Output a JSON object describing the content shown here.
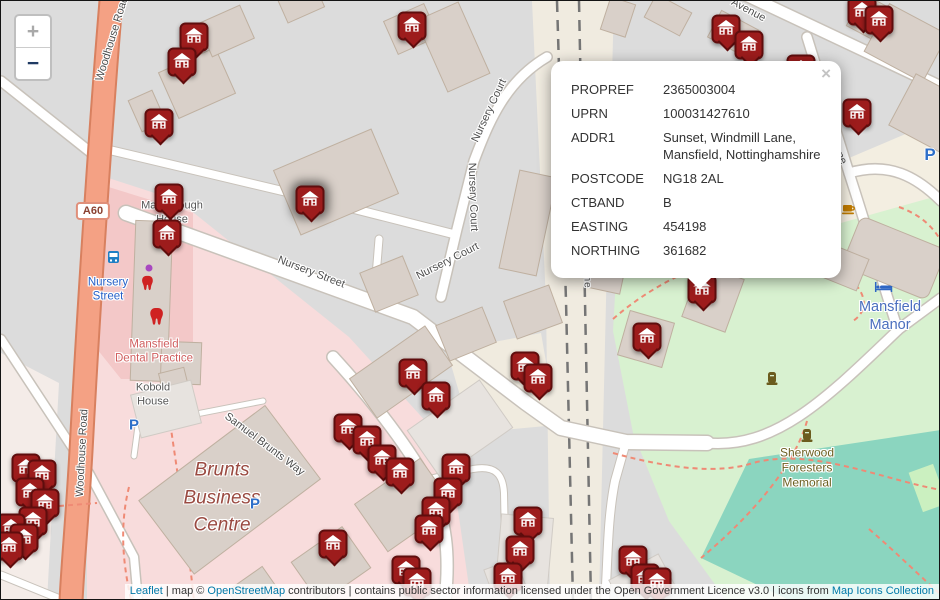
{
  "controls": {
    "zoom_in": "+",
    "zoom_out": "−"
  },
  "popup": {
    "close": "×",
    "rows": [
      {
        "label": "PROPREF",
        "value": "2365003004"
      },
      {
        "label": "UPRN",
        "value": "100031427610"
      },
      {
        "label": "ADDR1",
        "value": "Sunset, Windmill Lane, Mansfield, Nottinghamshire"
      },
      {
        "label": "POSTCODE",
        "value": "NG18 2AL"
      },
      {
        "label": "CTBAND",
        "value": "B"
      },
      {
        "label": "EASTING",
        "value": "454198"
      },
      {
        "label": "NORTHING",
        "value": "361682"
      }
    ]
  },
  "map": {
    "labels": {
      "woodhouse_top": "Woodhouse Road",
      "woodhouse_side": "Woodhouse Road",
      "a60": "A60",
      "marlborough": "Marlborough House",
      "transit_stop": "Nursery Street",
      "dental": "Mansfield Dental Practice",
      "kobold": "Kobold House",
      "brunts": "Brunts Business Centre",
      "samuel_brunts": "Samuel Brunts Way",
      "nursery_street_road": "Nursery Street",
      "nursery_court_1": "Nursery Court",
      "nursery_court_2": "Nursery Court",
      "nursery_court_3": "Nursery Court",
      "avenue": "Avenue",
      "windmill_lane": "Windmill Lane",
      "railway": "Robin Hood Line",
      "manor": "Mansfield Manor",
      "memorial": "Sherwood Foresters Memorial",
      "parking": "P"
    },
    "colors": {
      "marker": "#9d1c1c",
      "road_primary": "#f4a184",
      "park": "#d8f1d0",
      "pitch": "#8bd5bf",
      "hospital_pink": "#f8dcdc",
      "link_blue": "#0078a8"
    },
    "markers": [
      {
        "x": 193,
        "y": 36
      },
      {
        "x": 181,
        "y": 61
      },
      {
        "x": 158,
        "y": 122
      },
      {
        "x": 411,
        "y": 25
      },
      {
        "x": 725,
        "y": 28
      },
      {
        "x": 748,
        "y": 44
      },
      {
        "x": 861,
        "y": 10
      },
      {
        "x": 878,
        "y": 19
      },
      {
        "x": 856,
        "y": 112
      },
      {
        "x": 800,
        "y": 68
      },
      {
        "x": 168,
        "y": 197
      },
      {
        "x": 166,
        "y": 233
      },
      {
        "x": 309,
        "y": 199,
        "selected": true
      },
      {
        "x": 701,
        "y": 288
      },
      {
        "x": 646,
        "y": 336
      },
      {
        "x": 524,
        "y": 365
      },
      {
        "x": 537,
        "y": 377
      },
      {
        "x": 412,
        "y": 372
      },
      {
        "x": 435,
        "y": 395
      },
      {
        "x": 347,
        "y": 427
      },
      {
        "x": 366,
        "y": 439
      },
      {
        "x": 381,
        "y": 458
      },
      {
        "x": 399,
        "y": 471
      },
      {
        "x": 455,
        "y": 467
      },
      {
        "x": 447,
        "y": 491
      },
      {
        "x": 435,
        "y": 510
      },
      {
        "x": 428,
        "y": 528
      },
      {
        "x": 332,
        "y": 543
      },
      {
        "x": 527,
        "y": 520
      },
      {
        "x": 519,
        "y": 549
      },
      {
        "x": 507,
        "y": 576
      },
      {
        "x": 632,
        "y": 559
      },
      {
        "x": 644,
        "y": 577
      },
      {
        "x": 656,
        "y": 581
      },
      {
        "x": 405,
        "y": 569
      },
      {
        "x": 416,
        "y": 581
      },
      {
        "x": 25,
        "y": 467
      },
      {
        "x": 41,
        "y": 473
      },
      {
        "x": 29,
        "y": 491
      },
      {
        "x": 44,
        "y": 502
      },
      {
        "x": 32,
        "y": 520
      },
      {
        "x": 10,
        "y": 527
      },
      {
        "x": 23,
        "y": 537
      },
      {
        "x": 8,
        "y": 545
      }
    ]
  },
  "attribution": {
    "leaflet": "Leaflet",
    "sep1": " | map © ",
    "osm": "OpenStreetMap",
    "middle": " contributors | contains public sector information licensed under the Open Government Licence v3.0 | icons from ",
    "icons": "Map Icons Collection"
  }
}
